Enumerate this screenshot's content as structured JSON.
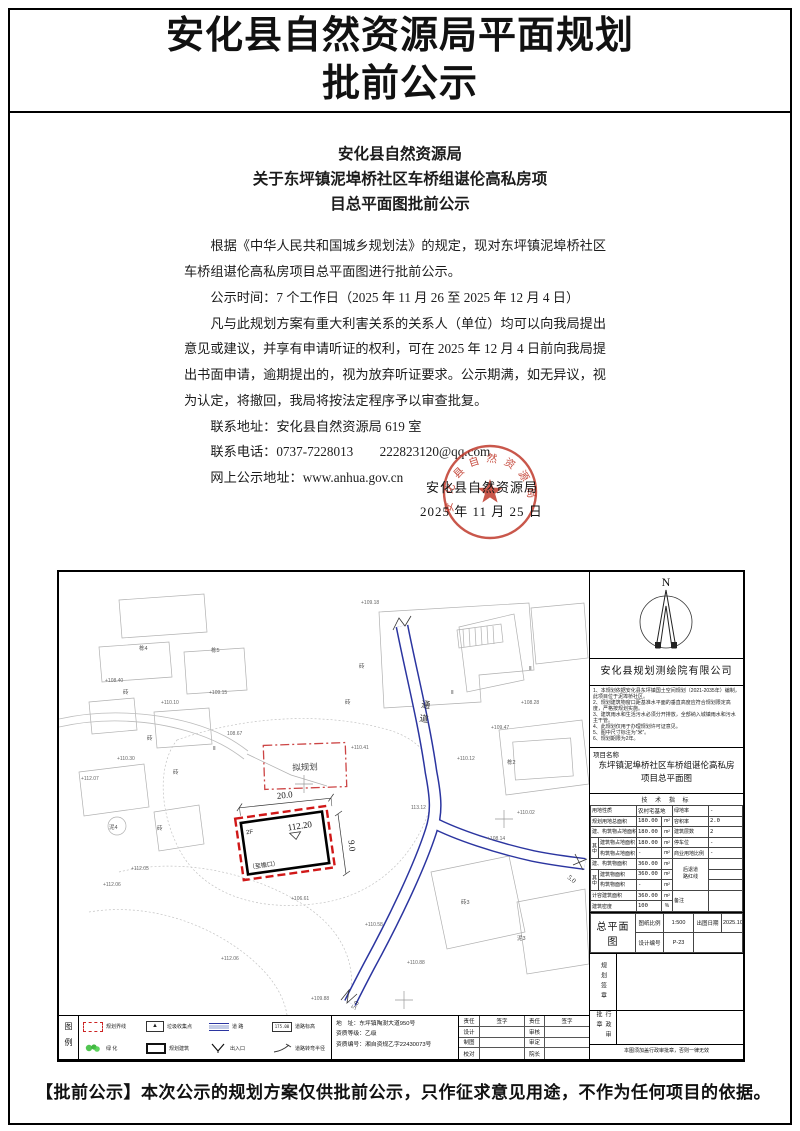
{
  "colors": {
    "seal_red": "#c0392b",
    "boundary_red": "#d01818",
    "road_blue": "#2b35a0"
  },
  "header": {
    "title_line1": "安化县自然资源局平面规划",
    "title_line2": "批前公示"
  },
  "notice": {
    "heading_line1": "安化县自然资源局",
    "heading_line2": "关于东坪镇泥埠桥社区车桥组谌伦高私房项",
    "heading_line3": "目总平面图批前公示",
    "para1": "根据《中华人民共和国城乡规划法》的规定，现对东坪镇泥埠桥社区车桥组谌伦高私房项目总平面图进行批前公示。",
    "para2": "公示时间：7 个工作日（2025 年 11 月 26 至 2025 年 12 月 4 日）",
    "para3": "凡与此规划方案有重大利害关系的关系人（单位）均可以向我局提出意见或建议，并享有申请听证的权利，可在 2025 年 12 月 4 日前向我局提出书面申请，逾期提出的，视为放弃听证要求。公示期满，如无异议，视为认定，将撤回，我局将按法定程序予以审查批复。",
    "contact_address": "联系地址：安化县自然资源局 619 室",
    "contact_phone": "联系电话：0737-7228013　　222823120@qq.com",
    "online_address": "网上公示地址：www.anhua.gov.cn",
    "seal": {
      "arc_text": "安化县自然资源局",
      "org_line": "安化县自然资源局",
      "date_line": "2025 年 11 月 25 日"
    }
  },
  "map": {
    "compass": "N",
    "road_label": "通道",
    "proposed_label": "拟规划",
    "building": {
      "width_dim": "20.0",
      "height_dim": "9.0",
      "elevation": "112.20",
      "floors": "2F",
      "eave": "（至檐口）"
    },
    "road_width_label_1": "5.0",
    "road_width_label_2": "5.0",
    "labels": [
      {
        "t": "栋4",
        "x": 80,
        "y": 78
      },
      {
        "t": "栋5",
        "x": 152,
        "y": 80
      },
      {
        "t": "砖",
        "x": 64,
        "y": 122
      },
      {
        "t": "+108.40",
        "x": 46,
        "y": 110
      },
      {
        "t": "+110.10",
        "x": 102,
        "y": 132
      },
      {
        "t": "+109.15",
        "x": 150,
        "y": 122
      },
      {
        "t": "砖",
        "x": 88,
        "y": 168
      },
      {
        "t": "108.67",
        "x": 168,
        "y": 163
      },
      {
        "t": "+112.07",
        "x": 22,
        "y": 208
      },
      {
        "t": "+110.30",
        "x": 58,
        "y": 188
      },
      {
        "t": "砖",
        "x": 114,
        "y": 202
      },
      {
        "t": "泥4",
        "x": 50,
        "y": 257
      },
      {
        "t": "砖",
        "x": 98,
        "y": 258
      },
      {
        "t": "+109.18",
        "x": 302,
        "y": 32
      },
      {
        "t": "砖",
        "x": 300,
        "y": 96
      },
      {
        "t": "砖",
        "x": 286,
        "y": 132
      },
      {
        "t": "+108.28",
        "x": 462,
        "y": 132
      },
      {
        "t": "+109.47",
        "x": 432,
        "y": 157
      },
      {
        "t": "+110.41",
        "x": 292,
        "y": 177
      },
      {
        "t": "+110.12",
        "x": 398,
        "y": 188
      },
      {
        "t": "栋2",
        "x": 448,
        "y": 192
      },
      {
        "t": "113.12",
        "x": 352,
        "y": 237
      },
      {
        "t": "+110.02",
        "x": 458,
        "y": 242
      },
      {
        "t": "+108.14",
        "x": 428,
        "y": 268
      },
      {
        "t": "+112.05",
        "x": 72,
        "y": 298
      },
      {
        "t": "+112.06",
        "x": 44,
        "y": 314
      },
      {
        "t": "+106.61",
        "x": 232,
        "y": 328
      },
      {
        "t": "+110.58",
        "x": 306,
        "y": 354
      },
      {
        "t": "砖3",
        "x": 402,
        "y": 332
      },
      {
        "t": "泥3",
        "x": 458,
        "y": 368
      },
      {
        "t": "+110.88",
        "x": 348,
        "y": 392
      },
      {
        "t": "+112.06",
        "x": 162,
        "y": 388
      },
      {
        "t": "+109.88",
        "x": 252,
        "y": 428
      },
      {
        "t": "Ⅱ",
        "x": 154,
        "y": 178
      },
      {
        "t": "Ⅱ",
        "x": 392,
        "y": 122
      },
      {
        "t": "Ⅱ",
        "x": 470,
        "y": 98
      }
    ]
  },
  "drawing": {
    "company": "安化县规划测绘院有限公司",
    "notes": [
      "1、本规划依据安化县东坪镇国土空间规划（2021-2035年）编制，此项目位于泥埠桥社区。",
      "2、规划建筑物窗口距基准水平面的垂直高度应符合规划限定高度，严格按规划实施。",
      "3、建筑雨水和生活污水必须分开排放，全部纳入城镇雨水和污水主干管。",
      "4、此规划仅用于办理规划许可证意见。",
      "5、图中尺寸标注为“米”。",
      "6、规划期限为2年。"
    ],
    "project": {
      "label": "项目名称",
      "name_line1": "东坪镇泥埠桥社区车桥组谌伦高私房",
      "name_line2": "项目总平面图"
    },
    "tech": {
      "title": "技 术 指 标",
      "zhong": "其中",
      "r1": {
        "l": "用地性质",
        "v": "农村宅基地",
        "l2": "绿地率",
        "v2": "-"
      },
      "r2": {
        "l": "规划用地总面积",
        "v": "180.00",
        "u": "m²",
        "l2": "容积率",
        "v2": "2.0"
      },
      "r3": {
        "l": "建、构筑物占地面积",
        "v": "180.00",
        "u": "m²",
        "l2": "建筑层数",
        "v2": "2"
      },
      "r4": {
        "l": "建筑物占地面积",
        "v": "180.00",
        "u": "m²",
        "l2": "停车位",
        "v2": "-"
      },
      "r5": {
        "l": "构筑物占地面积",
        "v": "-",
        "u": "m²",
        "l2": "商业用地比例",
        "v2": "-"
      },
      "r6": {
        "l": "建、构筑物面积",
        "v": "360.00",
        "u": "m²",
        "l2": "后退道路红线"
      },
      "r7": {
        "l": "建筑物面积",
        "v": "360.00",
        "u": "m²"
      },
      "r8": {
        "l": "构筑物面积",
        "v": "-",
        "u": "m²"
      },
      "r9": {
        "l": "计容建筑面积",
        "v": "360.00",
        "u": "m²",
        "l2": "备注"
      },
      "r10": {
        "l": "建筑密度",
        "v": "100",
        "u": "%"
      }
    },
    "plan": {
      "title": "总平面图",
      "scale_label": "图纸比例",
      "scale": "1:500",
      "date_label": "出图日期",
      "date": "2025.10",
      "no_label": "设计编号",
      "no": "P-23"
    },
    "stamps": {
      "planning": "规划签章",
      "admin": "行政审批章",
      "note": "本图须加盖行政审批章，否则一律无效"
    },
    "legend": {
      "title": "图例",
      "items": [
        "规划界线",
        "垃圾收集点",
        "道  路",
        "道路标高",
        "绿  化",
        "规划建筑",
        "出入口",
        "道路转弯半径"
      ],
      "elev_symbol": "175.00"
    },
    "address": {
      "line1": "地　址：东坪镇陶澍大道950号",
      "line2": "资质等级：乙级",
      "line3": "资质编号：湘自资规乙字22430073号"
    },
    "sign": {
      "rows": [
        [
          "责任",
          "签字",
          "责任",
          "签字"
        ],
        [
          "设计",
          "",
          "审核",
          ""
        ],
        [
          "制图",
          "",
          "审定",
          ""
        ],
        [
          "校对",
          "",
          "院长",
          ""
        ]
      ]
    }
  },
  "footer": {
    "notice": "【批前公示】本次公示的规划方案仅供批前公示，只作征求意见用途，不作为任何项目的依据。"
  }
}
